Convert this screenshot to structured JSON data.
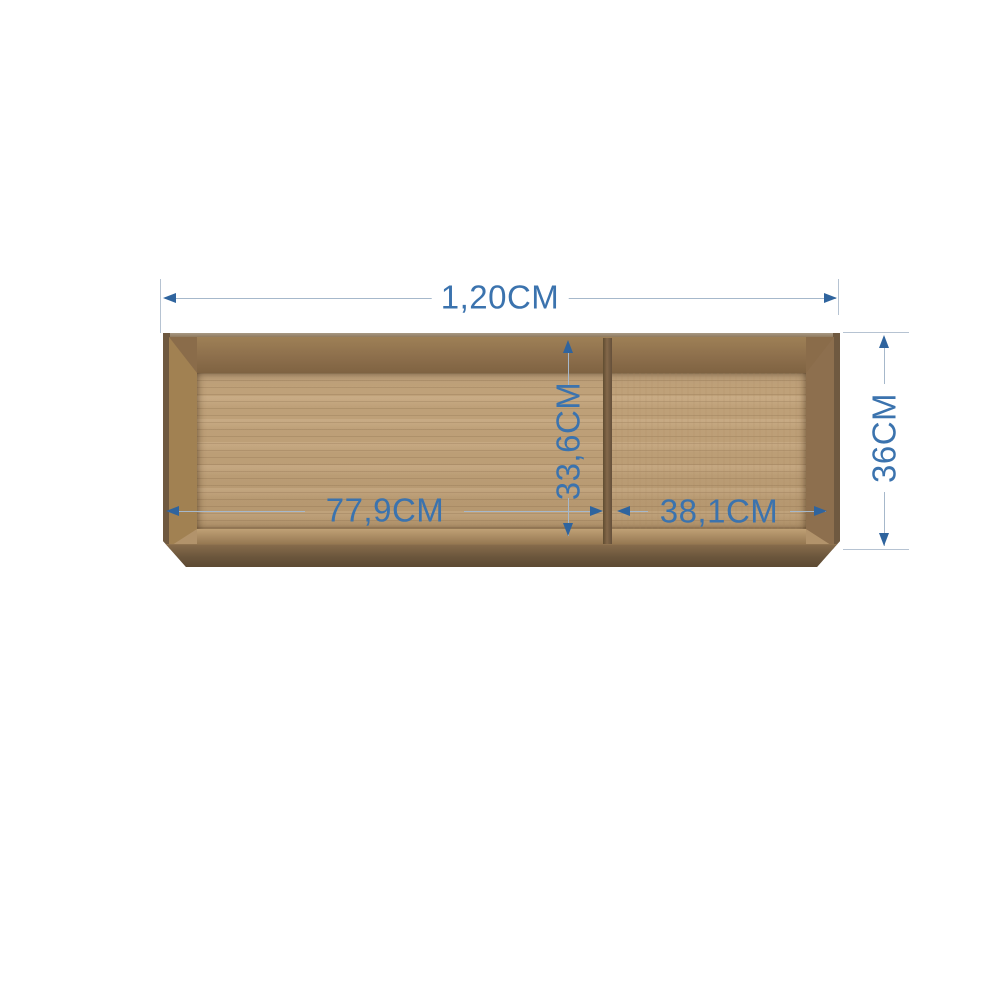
{
  "page": {
    "background": "#ffffff",
    "description": "Product dimension diagram of a two-compartment open wooden shelf"
  },
  "product": {
    "name": "two-compartment-open-shelf",
    "compartments": 2,
    "colors": {
      "frame_outer": "#7b6345",
      "frame_bevel_left": "#a18152",
      "frame_bevel_right": "#8d6f4e",
      "top_inner_band": "#8d6f4c",
      "back_panel": "#c2a37a",
      "bottom_inner_band": "#a1835c",
      "front_bottom_edge": "#6b563c",
      "divider": "#84684a"
    }
  },
  "annotations": {
    "color_text": "#3b73ae",
    "color_line": "#a6b8cb",
    "color_extension_line": "#b6c3d2",
    "color_arrow": "#2f649e",
    "overall_width": {
      "label": "1,20CM",
      "orientation": "horizontal",
      "position": "top"
    },
    "overall_height": {
      "label": "36CM",
      "orientation": "vertical",
      "position": "right"
    },
    "inner_height": {
      "label": "33,6CM",
      "orientation": "vertical",
      "position": "inside-left-of-divider"
    },
    "left_compartment_width": {
      "label": "77,9CM",
      "orientation": "horizontal",
      "position": "inside-left-compartment"
    },
    "right_compartment_width": {
      "label": "38,1CM",
      "orientation": "horizontal",
      "position": "inside-right-compartment"
    }
  }
}
